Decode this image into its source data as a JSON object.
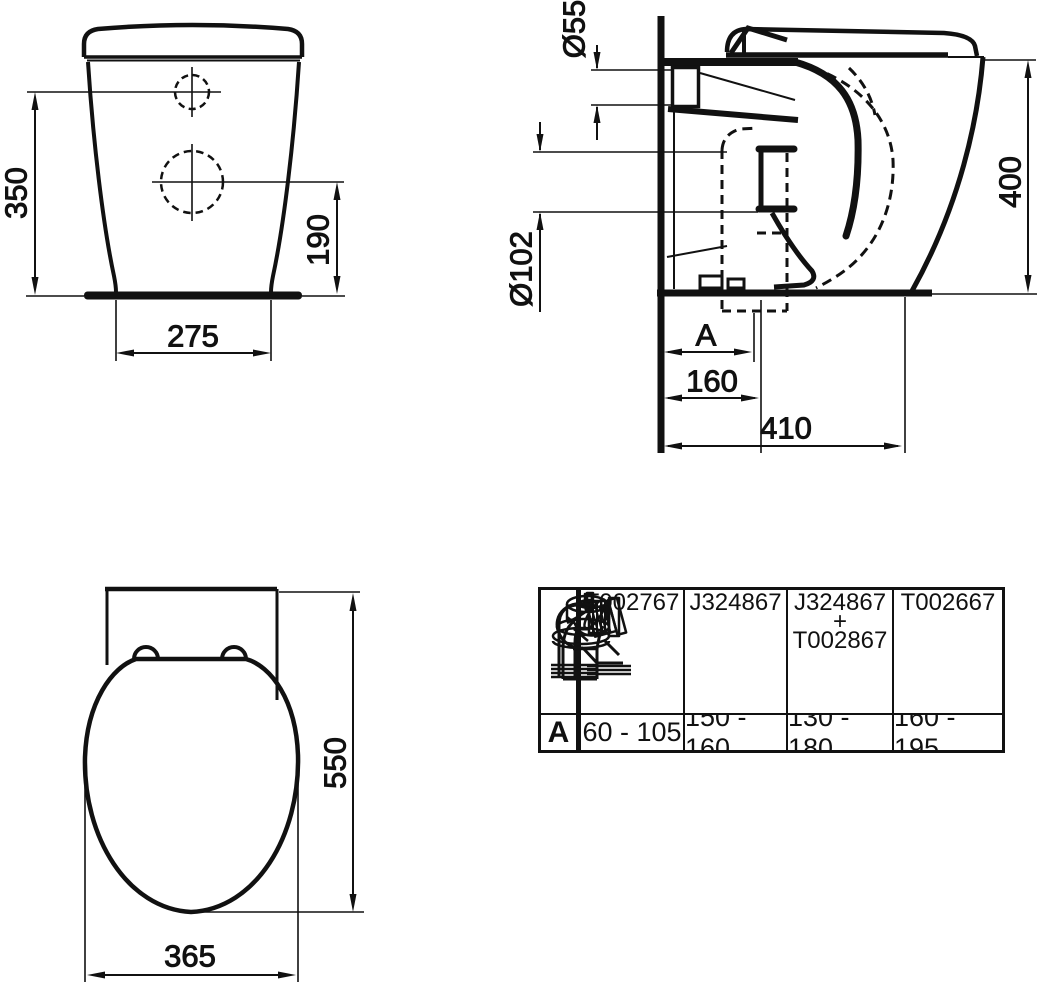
{
  "drawing_title": "Back-to-wall WC pan technical drawing",
  "front_view": {
    "inlet_height": "350",
    "outlet_height": "190",
    "base_width": "275"
  },
  "side_view": {
    "inlet_diameter": "Ø55",
    "pan_height": "400",
    "outlet_diameter": "Ø102",
    "adaptor_dim_label": "A",
    "outlet_distance": "160",
    "pan_depth": "410"
  },
  "plan_view": {
    "overall_depth": "550",
    "seat_width": "365"
  },
  "adaptor_table": {
    "row_label": "A",
    "columns": [
      {
        "code": "T002767",
        "icon": "elbow-horizontal-connector",
        "range": "60 - 105"
      },
      {
        "code": "J324867",
        "icon": "angled-connector",
        "range": "150 - 160"
      },
      {
        "code": "J324867\n+\nT002867",
        "icon": "offset-seal-connector",
        "range": "130 - 180"
      },
      {
        "code": "T002667",
        "icon": "elbow-angled-connector",
        "range": "160 - 195"
      }
    ]
  },
  "colors": {
    "line": "#111111",
    "background": "#ffffff"
  }
}
